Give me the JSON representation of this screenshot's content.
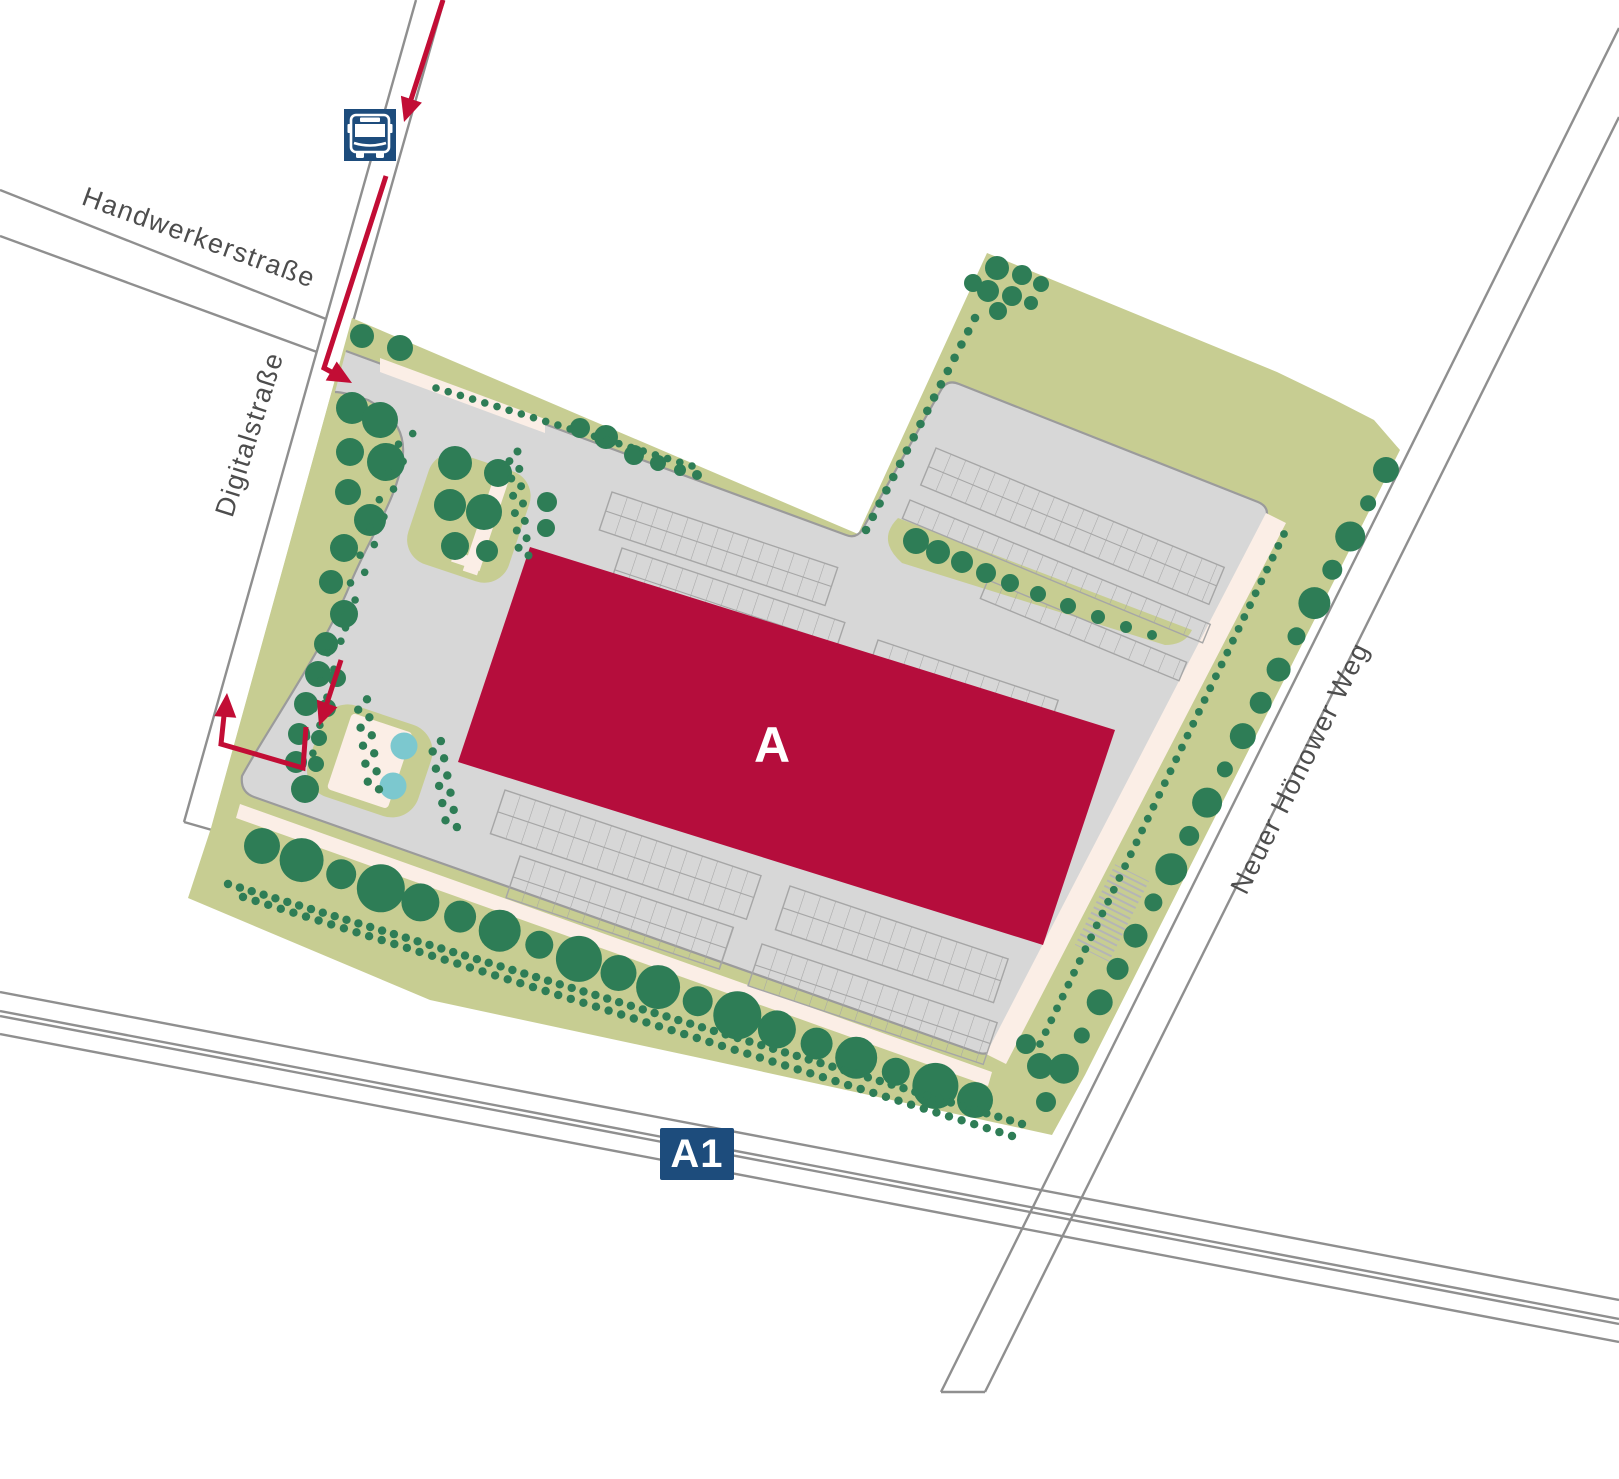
{
  "map": {
    "streets": [
      {
        "name": "Handwerkerstraße"
      },
      {
        "name": "Digitalstraße"
      },
      {
        "name": "Neuer Hönower Weg"
      }
    ],
    "highway": {
      "label": "A1"
    },
    "building": {
      "label": "A"
    },
    "icons": {
      "bus_stop": "bus-stop-icon"
    },
    "colors": {
      "background": "#ffffff",
      "site_green": "#c7cd92",
      "tree_green": "#2e7d56",
      "pavement_gray": "#d7d7d7",
      "pavement_border": "#9b9b9b",
      "stall_line": "#a6a6a6",
      "building_red": "#b50d3c",
      "route_red": "#c20d35",
      "path_cream": "#fbeee6",
      "pond_teal": "#7cc8cf",
      "badge_blue": "#1d4c7c",
      "road_casing": "#8f8f8f",
      "label_gray": "#4d4d4d"
    }
  }
}
